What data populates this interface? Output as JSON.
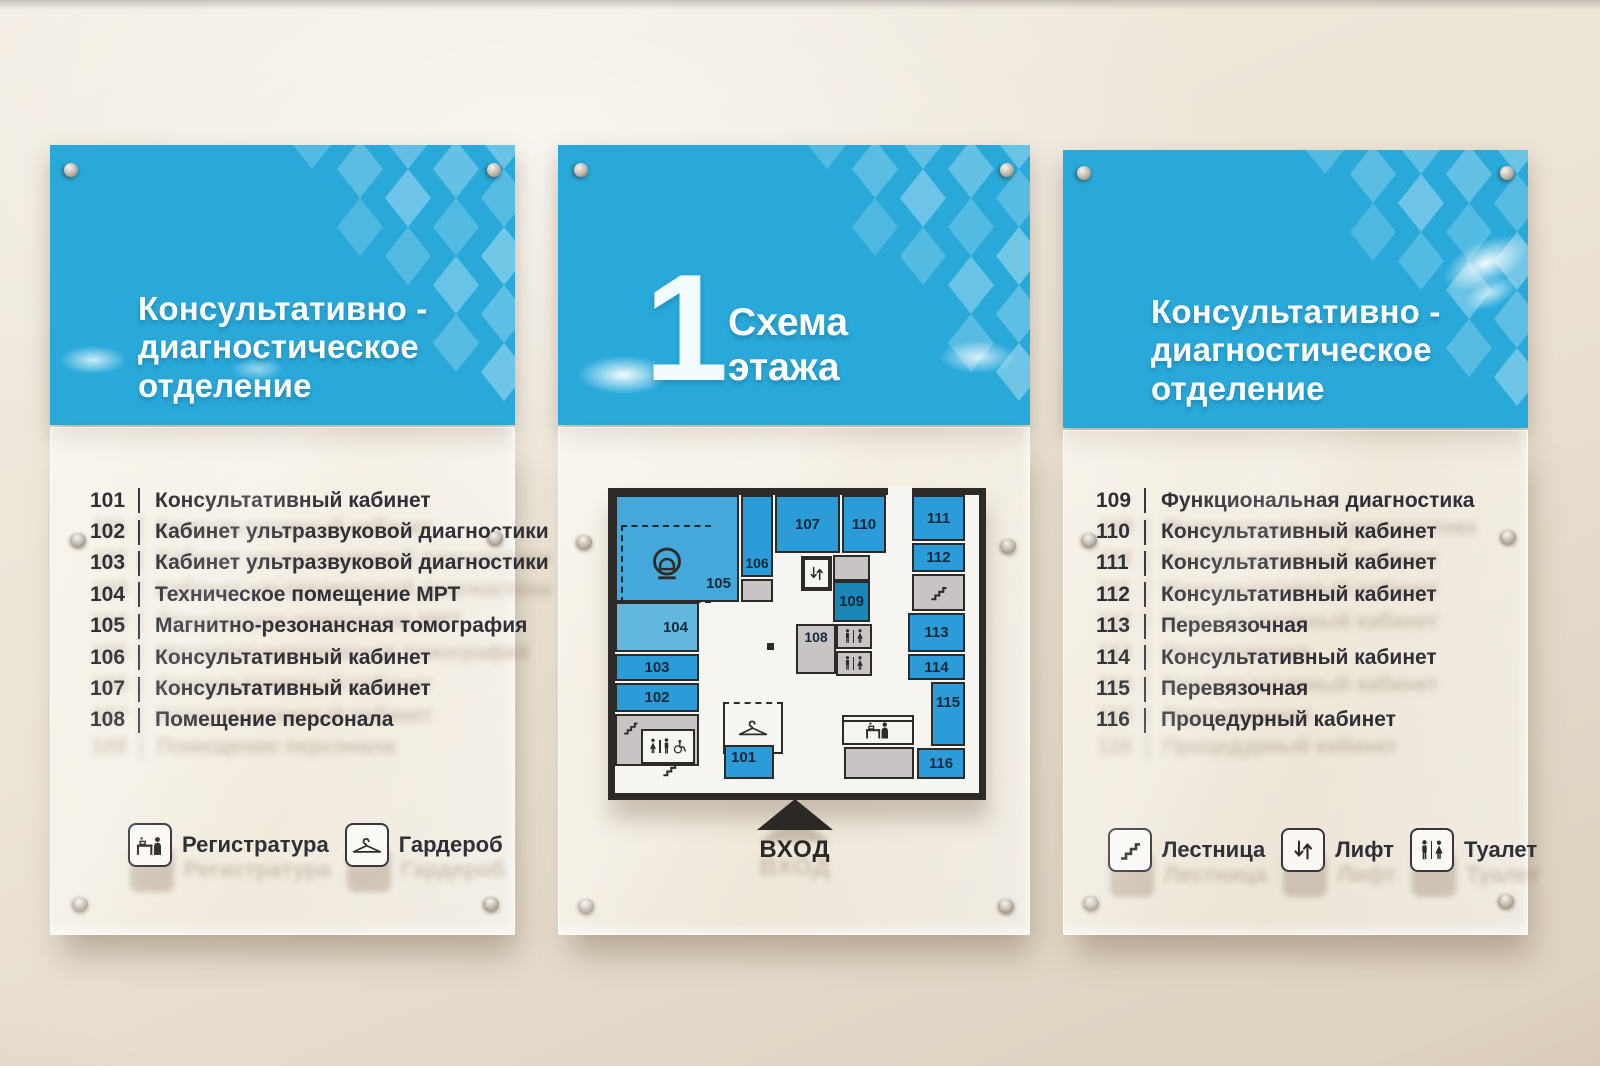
{
  "colors": {
    "header_blue": "#29a9da",
    "room_blue": "#2b9cd7",
    "room_blue_medium": "#44a9da",
    "room_blue_light": "#63b8e0",
    "room_blue_dark": "#1886b6",
    "room_gray": "#c9c4c4",
    "wall_line_dark": "#2d2a28",
    "list_text": "#322e35"
  },
  "left_panel": {
    "title_lines": [
      "Консультативно -",
      "диагностическое",
      "отделение"
    ],
    "rooms": [
      {
        "num": "101",
        "name": "Консультативный  кабинет"
      },
      {
        "num": "102",
        "name": "Кабинет ультразвуковой диагностики"
      },
      {
        "num": "103",
        "name": "Кабинет ультразвуковой диагностики"
      },
      {
        "num": "104",
        "name": "Техническое помещение МРТ"
      },
      {
        "num": "105",
        "name": "Магнитно-резонансная томография"
      },
      {
        "num": "106",
        "name": "Консультативный  кабинет"
      },
      {
        "num": "107",
        "name": "Консультативный  кабинет"
      },
      {
        "num": "108",
        "name": "Помещение персонала"
      }
    ],
    "legend": [
      {
        "icon": "reception-icon",
        "label": "Регистратура"
      },
      {
        "icon": "hanger-icon",
        "label": "Гардероб"
      }
    ]
  },
  "center_panel": {
    "floor_number": "1",
    "title_lines": [
      "Схема",
      "этажа"
    ],
    "entrance_label": "ВХОД",
    "plan_rooms": [
      "101",
      "102",
      "103",
      "104",
      "105",
      "106",
      "107",
      "108",
      "109",
      "110",
      "111",
      "112",
      "113",
      "114",
      "115",
      "116"
    ],
    "plan_icons": [
      "mri-icon",
      "lift-icon",
      "stairs-icon",
      "toilet-icon",
      "accessible-toilet-icon",
      "hanger-icon",
      "reception-icon"
    ]
  },
  "right_panel": {
    "title_lines": [
      "Консультативно -",
      "диагностическое",
      "отделение"
    ],
    "rooms": [
      {
        "num": "109",
        "name": "Функциональная диагностика"
      },
      {
        "num": "110",
        "name": "Консультативный кабинет"
      },
      {
        "num": "111",
        "name": "Консультативный кабинет"
      },
      {
        "num": "112",
        "name": "Консультативный кабинет"
      },
      {
        "num": "113",
        "name": "Перевязочная"
      },
      {
        "num": "114",
        "name": "Консультативный кабинет"
      },
      {
        "num": "115",
        "name": "Перевязочная"
      },
      {
        "num": "116",
        "name": "Процедурный кабинет"
      }
    ],
    "legend": [
      {
        "icon": "stairs-icon",
        "label": "Лестница"
      },
      {
        "icon": "lift-icon",
        "label": "Лифт"
      },
      {
        "icon": "toilet-icon",
        "label": "Туалет"
      }
    ]
  }
}
